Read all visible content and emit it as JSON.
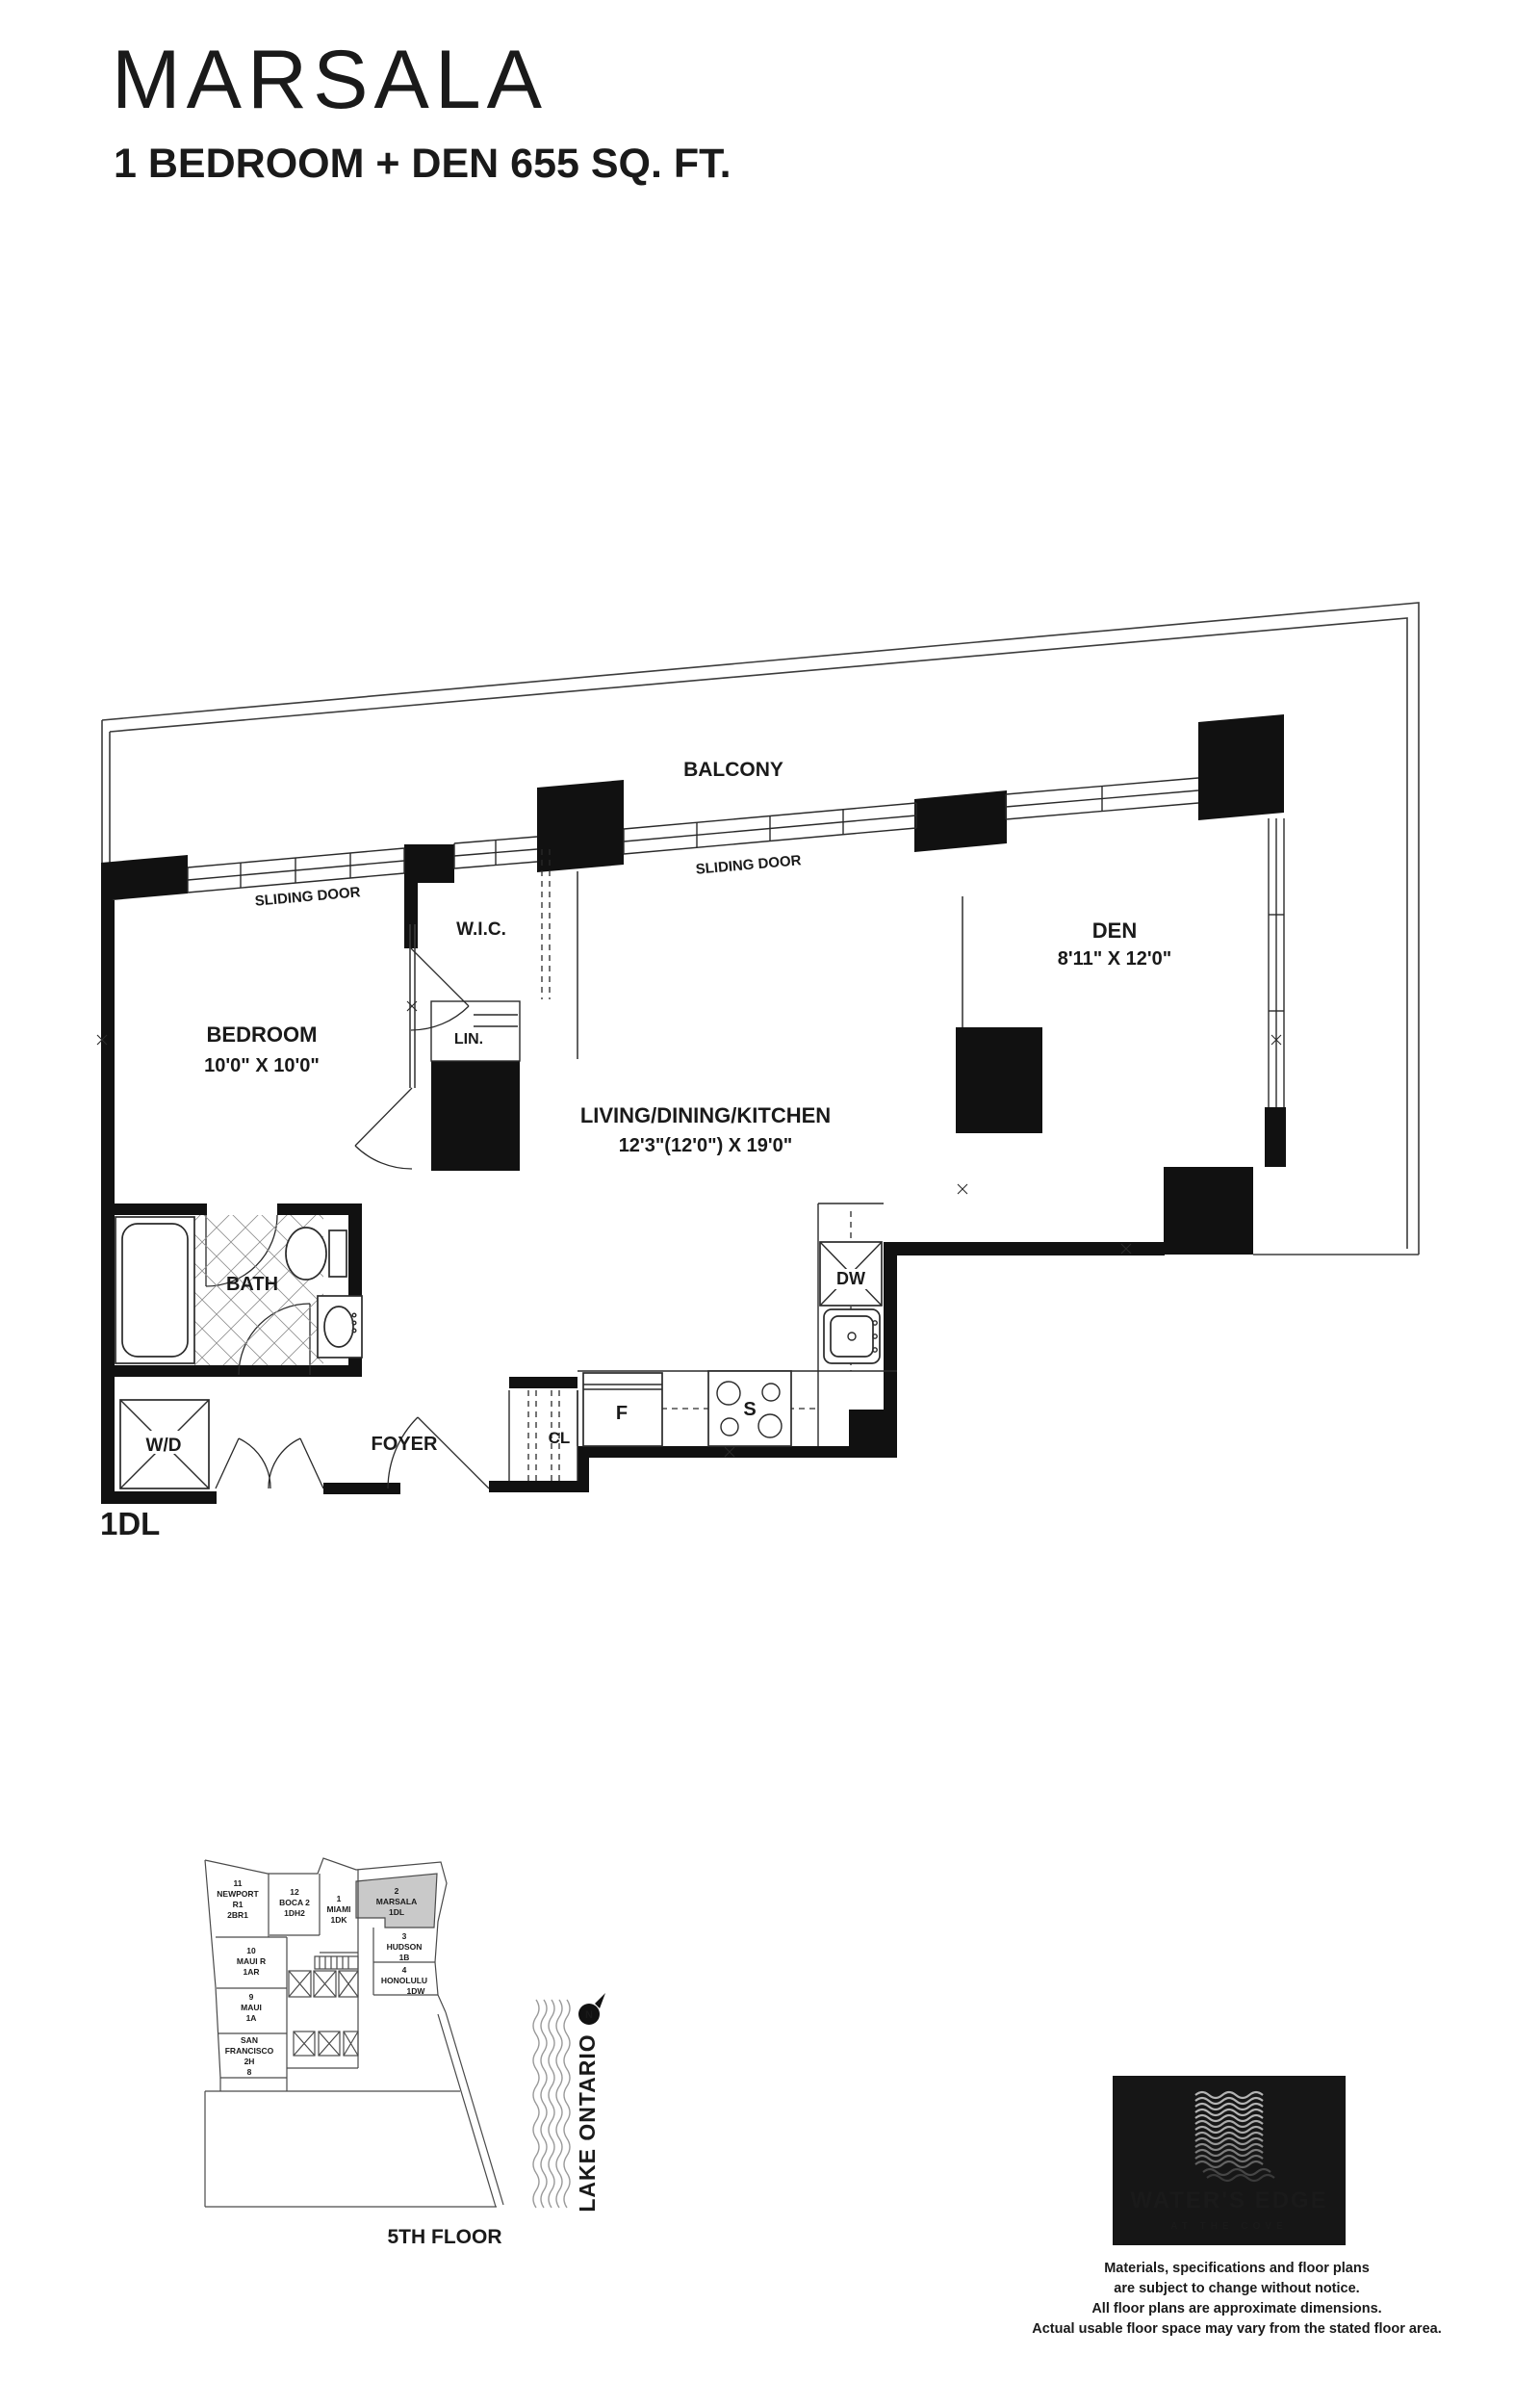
{
  "header": {
    "title": "MARSALA",
    "subtitle": "1 BEDROOM + DEN 655 SQ. FT."
  },
  "floorplan": {
    "unit_type_code": "1DL",
    "rooms": {
      "balcony": "BALCONY",
      "sliding_door": "SLIDING DOOR",
      "wic": "W.I.C.",
      "lin": "LIN.",
      "bedroom": {
        "name": "BEDROOM",
        "dims": "10'0\" X 10'0\""
      },
      "den": {
        "name": "DEN",
        "dims": "8'11\" X 12'0\""
      },
      "living": {
        "name": "LIVING/DINING/KITCHEN",
        "dims": "12'3\"(12'0\") X 19'0\""
      },
      "bath": "BATH",
      "foyer": "FOYER",
      "closet": "CL",
      "washer_dryer": "W/D",
      "dishwasher": "DW",
      "fridge": "F",
      "stove": "S"
    }
  },
  "keyplan": {
    "floor_label": "5TH FLOOR",
    "water_label": "LAKE ONTARIO",
    "compass": "N",
    "units": [
      {
        "lines": [
          "11",
          "NEWPORT",
          "R1",
          "2BR1"
        ],
        "highlighted": false
      },
      {
        "lines": [
          "12",
          "BOCA 2",
          "1DH2"
        ],
        "highlighted": false
      },
      {
        "lines": [
          "1",
          "MIAMI",
          "1DK"
        ],
        "highlighted": false
      },
      {
        "lines": [
          "2",
          "MARSALA",
          "1DL"
        ],
        "highlighted": true
      },
      {
        "lines": [
          "3",
          "HUDSON",
          "1B"
        ],
        "highlighted": false
      },
      {
        "lines": [
          "4",
          "HONOLULU",
          "1DW"
        ],
        "highlighted": false
      },
      {
        "lines": [
          "10",
          "MAUI R",
          "1AR"
        ],
        "highlighted": false
      },
      {
        "lines": [
          "9",
          "MAUI",
          "1A"
        ],
        "highlighted": false
      },
      {
        "lines": [
          "SAN",
          "FRANCISCO",
          "2H",
          "8"
        ],
        "highlighted": false
      }
    ]
  },
  "logo": {
    "name": "WATER'S EDGE",
    "tagline": "AT THE COVE"
  },
  "disclaimer": {
    "lines": [
      "Materials, specifications and floor plans",
      "are subject to change without notice.",
      "All floor plans are approximate dimensions.",
      "Actual usable floor space may vary from the stated floor area."
    ]
  },
  "colors": {
    "ink": "#1a1a1a",
    "highlight": "#c9c9c9",
    "logo_bg": "#161616",
    "water_line": "#9a9a9a"
  }
}
